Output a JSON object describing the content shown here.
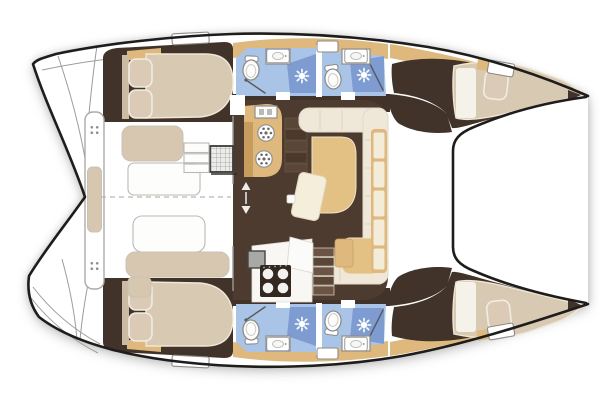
{
  "canvas": {
    "width": 600,
    "height": 400
  },
  "plan": {
    "vessel_type": "catamaran",
    "view": "overhead-deck-plan",
    "bow_direction": "right",
    "counts": {
      "hulls": 2,
      "cabins": 4,
      "double_berths": 4,
      "heads": 4,
      "toilets": 4,
      "shower_roses": 4,
      "head_sinks": 4,
      "deck_hatches": 6,
      "galley_round_sinks": 2,
      "stove_burners": 4,
      "cockpit_benches": 4,
      "swim_platforms": 2,
      "trampolines": 1
    },
    "areas": {
      "salon": {
        "features": [
          "galley-counter",
          "double-round-sinks",
          "fridge",
          "four-burner-stove",
          "u-shaped-sofa",
          "chaise-cushion",
          "dining-table",
          "port-companionway-steps",
          "starboard-companionway-stairs",
          "forward-window-wall"
        ]
      },
      "cockpit": {
        "features": [
          "aft-bench",
          "aft-bench-cushion",
          "port-side-bench",
          "starboard-side-bench",
          "helm-module",
          "access-steps",
          "centerline-seam"
        ]
      },
      "port_hull": {
        "features": [
          "swim-platform-steps",
          "aft-cabin-double-berth",
          "two-pillows",
          "aft-head",
          "forward-head",
          "forward-cabin-v-berth",
          "deck-hatches"
        ]
      },
      "starboard_hull": {
        "features": [
          "swim-platform-steps",
          "aft-cabin-double-berth",
          "two-pillows",
          "aft-head",
          "forward-head",
          "forward-cabin-v-berth",
          "deck-hatches"
        ]
      },
      "foredeck": {
        "features": [
          "trampoline"
        ]
      }
    }
  },
  "colors": {
    "hull_outline": "#1e1d1b",
    "deck_white": "#ffffff",
    "deck_line": "#9c9c98",
    "floor_hull": "#41332a",
    "floor_salon": "#4d3b30",
    "wood_tan": "#deb87c",
    "wood_tan_dark": "#c89c5c",
    "upholstery_beige": "#d7c6b0",
    "upholstery_cream": "#efe8d9",
    "cushion_tan": "#e3c084",
    "bed_beige": "#d8c9b2",
    "bed_stroke": "#efe7d7",
    "pillow_beige": "#dbcbb6",
    "table_cream": "#f4eedb",
    "head_floor_blue": "#a9c4e6",
    "shower_blue": "#7e9cd2",
    "fixture_white": "#fdfdfc",
    "fixture_stroke": "#8d8d8b",
    "appliance_gray": "#a8a8a6",
    "stove_dark": "#33281f",
    "step_light": "#6b5444",
    "step_dark": "#5a4636",
    "stair_edge": "#cfc7bc",
    "dash_gray": "#b7b7b1"
  }
}
